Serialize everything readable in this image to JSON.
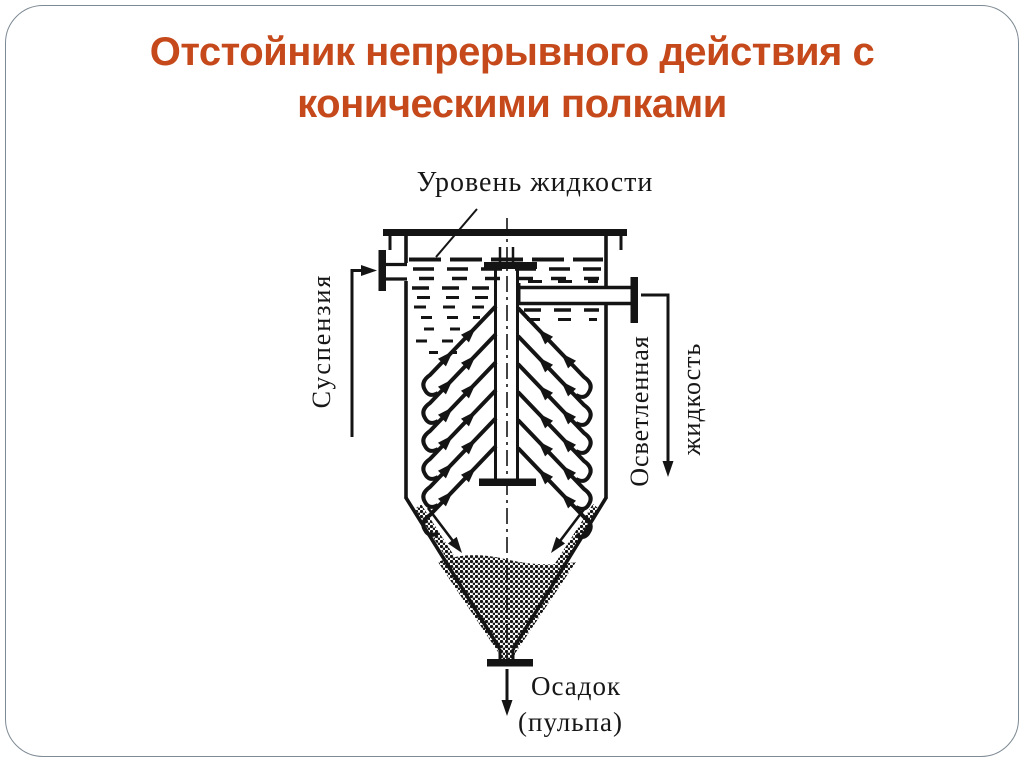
{
  "slide": {
    "title_line1": "Отстойник непрерывного действия с",
    "title_line2": "коническими полками",
    "title_color": "#c5491b",
    "border_color": "#7e8a94",
    "background_color": "#ffffff"
  },
  "diagram": {
    "ink_color": "#141414",
    "shelves_per_side": 6,
    "labels": {
      "liquid_level": "Уровень жидкости",
      "suspension": "Суспензия",
      "clarified_line1": "Осветленная",
      "clarified_line2": "жидкость",
      "sediment_line1": "Осадок",
      "sediment_line2": "(пульпа)"
    }
  }
}
